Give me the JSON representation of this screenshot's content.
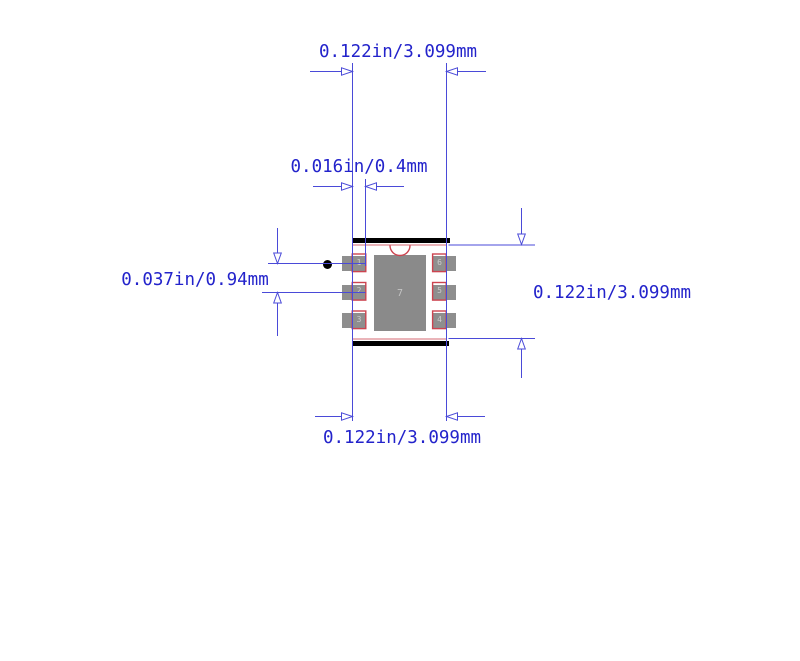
{
  "drawing": {
    "type": "pcb-footprint-dimension-drawing",
    "dimension_labels": {
      "top_width": "0.122in/3.099mm",
      "pin_length": "0.016in/0.4mm",
      "pin_pitch": "0.037in/0.94mm",
      "right_height": "0.122in/3.099mm",
      "bottom_width": "0.122in/3.099mm"
    },
    "footprint": {
      "pads": {
        "left": [
          "1",
          "2",
          "3"
        ],
        "right": [
          "6",
          "5",
          "4"
        ],
        "center": "7"
      }
    },
    "icons": {
      "pin1_marker": "pin1-dot-icon",
      "pin1_notch": "pin1-notch-arc-icon",
      "arrows": "dimension-arrow-icon"
    },
    "colors": {
      "background": "#ffffff",
      "dimension_text_blue": "#2323cb",
      "dimension_line_blue": "#4a4ad8",
      "pad_gray": "#8e8e8e",
      "center_pad_gray": "#8a8a8a",
      "pad_number_gray": "#cccccc",
      "courtyard_red": "#cc4450",
      "silkscreen_black": "#000000"
    }
  }
}
